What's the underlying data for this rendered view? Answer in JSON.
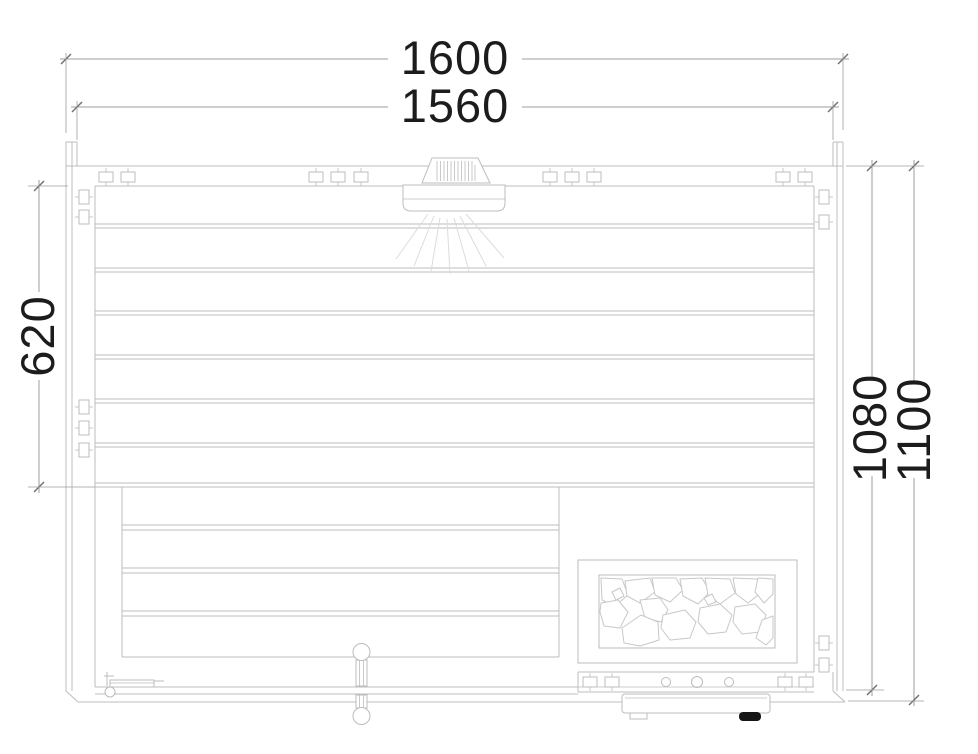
{
  "drawing": {
    "dims": {
      "width_overall": "1600",
      "width_back_wall": "1560",
      "bench_depth": "620",
      "depth_inner": "1080",
      "depth_overall": "1100"
    },
    "colors": {
      "object_line": "#bcbcbc",
      "dimension_line": "#9c9c9c",
      "text": "#1c1c1c",
      "background": "#ffffff",
      "knob_fill": "#161616"
    }
  }
}
